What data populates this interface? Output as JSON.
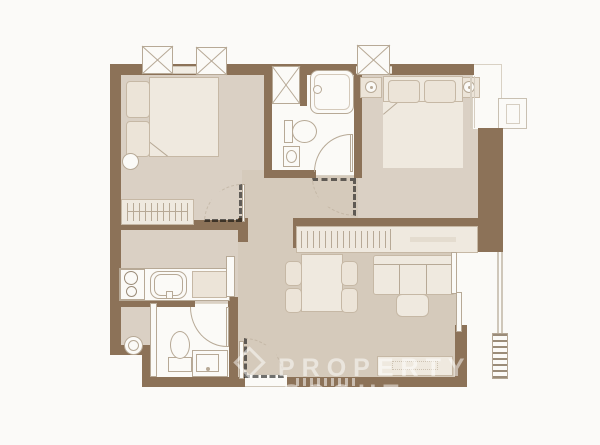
{
  "canvas": {
    "width": 600,
    "height": 445
  },
  "palette": {
    "page": "#fbfaf8",
    "wall": "#8c7258",
    "floor": "#dad0c4",
    "floor2": "#d5cabb",
    "white": "#fbfaf7",
    "furn": "#efe9df",
    "furn2": "#ece4d8",
    "furnline": "#c6b8a5",
    "fixline": "#b7a996",
    "hatch": "#9b8c79",
    "wmcolor": "rgba(255,255,255,0.5)"
  },
  "watermark": {
    "line1": "PROPERTY",
    "line2": "SCOUT",
    "logo": "diamond-logo"
  },
  "plan": {
    "type": "apartment-floor-plan",
    "rooms": [
      {
        "name": "bedroom-1",
        "furniture": [
          "single-bed-with-pillows",
          "bedside-stool",
          "wardrobe-with-hangers"
        ]
      },
      {
        "name": "bathroom-1",
        "furniture": [
          "shower-stall",
          "bathtub",
          "toilet",
          "sink",
          "door-swing"
        ]
      },
      {
        "name": "bedroom-2",
        "furniture": [
          "double-bed-two-pillows",
          "nightstand-lamp-left",
          "nightstand-lamp-right",
          "window"
        ]
      },
      {
        "name": "hallway",
        "furniture": [
          "door-swing-dashed"
        ]
      },
      {
        "name": "kitchen",
        "furniture": [
          "two-burner-stove",
          "counter-sink",
          "cabinet",
          "tall-cabinet"
        ]
      },
      {
        "name": "utility-nook",
        "furniture": [
          "washing-machine"
        ]
      },
      {
        "name": "bathroom-2",
        "furniture": [
          "toilet",
          "vanity-sink",
          "door-swing",
          "sliding-door"
        ]
      },
      {
        "name": "living-dining",
        "furniture": [
          "built-in-wardrobe",
          "dining-table-four-chairs",
          "sofa-three-seat",
          "coffee-table",
          "tv-console",
          "entrance-door"
        ]
      },
      {
        "name": "balcony",
        "furniture": [
          "railing",
          "ac-condenser",
          "sliding-glass-door"
        ]
      }
    ],
    "exterior": [
      "ac-unit-1",
      "ac-unit-2",
      "ac-unit-3",
      "corner-ledge",
      "side-window"
    ]
  }
}
